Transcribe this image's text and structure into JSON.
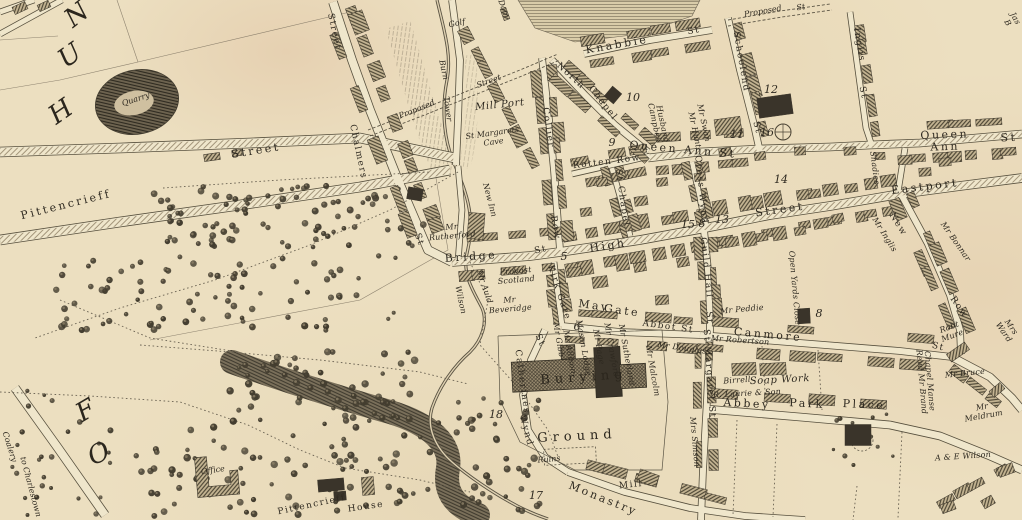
{
  "map": {
    "palette": {
      "paper": "#ecdfc0",
      "ink": "#3b352a",
      "road_fill": "#efe6cb",
      "building_hatch": "#6b6150",
      "dark_building": "#3a342a",
      "tree": "#433d2f"
    },
    "labels": [
      {
        "id": "letter-n",
        "text": "N",
        "x": 77,
        "y": 15,
        "r": -38,
        "c": "huge"
      },
      {
        "id": "letter-u",
        "text": "U",
        "x": 70,
        "y": 56,
        "r": -35,
        "c": "huge"
      },
      {
        "id": "letter-h",
        "text": "H",
        "x": 61,
        "y": 112,
        "r": -35,
        "c": "huge"
      },
      {
        "id": "letter-f",
        "text": "F",
        "x": 86,
        "y": 411,
        "r": -30,
        "c": "huge"
      },
      {
        "id": "letter-o",
        "text": "O",
        "x": 99,
        "y": 454,
        "r": -25,
        "c": "huge"
      },
      {
        "id": "quarry",
        "text": "Quarry",
        "x": 136,
        "y": 100,
        "r": -18,
        "c": "tiny-it"
      },
      {
        "id": "street-upper",
        "text": "Street",
        "x": 256,
        "y": 151,
        "r": -9,
        "c": "street"
      },
      {
        "id": "pittencrieff-street",
        "text": "Pittencrieff",
        "x": 66,
        "y": 205,
        "r": -14,
        "c": "street"
      },
      {
        "id": "chalmers",
        "text": "Chalmers",
        "x": 357,
        "y": 152,
        "r": 78,
        "c": "street-sm"
      },
      {
        "id": "chalmers-st",
        "text": "St",
        "x": 418,
        "y": 240,
        "r": 70,
        "c": "street-sm"
      },
      {
        "id": "street-top",
        "text": "Street",
        "x": 333,
        "y": 32,
        "r": 78,
        "c": "street-sm"
      },
      {
        "id": "golf",
        "text": "Golf",
        "x": 457,
        "y": 24,
        "r": -12,
        "c": "tiny-it"
      },
      {
        "id": "dam",
        "text": "Dam",
        "x": 503,
        "y": 9,
        "r": 70,
        "c": "tiny-it"
      },
      {
        "id": "tower-burn-1",
        "text": "Burn",
        "x": 443,
        "y": 70,
        "r": 78,
        "c": "tiny-it"
      },
      {
        "id": "tower-burn-2",
        "text": "Tower",
        "x": 447,
        "y": 109,
        "r": 82,
        "c": "tiny-it"
      },
      {
        "id": "proposed-street-w-1",
        "text": "Proposed",
        "x": 417,
        "y": 110,
        "r": -22,
        "c": "tiny-it"
      },
      {
        "id": "proposed-street-w-2",
        "text": "Street",
        "x": 489,
        "y": 82,
        "r": -20,
        "c": "tiny-it"
      },
      {
        "id": "mill-port",
        "text": "Mill Port",
        "x": 500,
        "y": 106,
        "r": -6,
        "c": "name-lg"
      },
      {
        "id": "st-margarets-cave",
        "text": "St Margarets\nCave",
        "x": 493,
        "y": 138,
        "r": -8,
        "c": "tiny-it"
      },
      {
        "id": "new-inn",
        "text": "New Inn",
        "x": 489,
        "y": 200,
        "r": 75,
        "c": "tiny-it"
      },
      {
        "id": "collier",
        "text": "Collier",
        "x": 547,
        "y": 128,
        "r": 82,
        "c": "street-sm"
      },
      {
        "id": "collier-row",
        "text": "Row",
        "x": 554,
        "y": 228,
        "r": 80,
        "c": "street-sm"
      },
      {
        "id": "north-chapel-1",
        "text": "North",
        "x": 570,
        "y": 77,
        "r": 42,
        "c": "street-sm"
      },
      {
        "id": "north-chapel-2",
        "text": "Chapel",
        "x": 602,
        "y": 104,
        "r": 52,
        "c": "street-sm"
      },
      {
        "id": "knabbie",
        "text": "Knabbie",
        "x": 617,
        "y": 45,
        "r": -10,
        "c": "street"
      },
      {
        "id": "knabbie-st",
        "text": "St",
        "x": 694,
        "y": 32,
        "r": -10,
        "c": "street-sm"
      },
      {
        "id": "proposed-street-ne-1",
        "text": "Proposed",
        "x": 763,
        "y": 12,
        "r": -10,
        "c": "tiny-it"
      },
      {
        "id": "proposed-street-ne-2",
        "text": "St",
        "x": 801,
        "y": 8,
        "r": -10,
        "c": "tiny-it"
      },
      {
        "id": "schoolend",
        "text": "Schoolend",
        "x": 740,
        "y": 62,
        "r": 80,
        "c": "street-sm"
      },
      {
        "id": "schoolend-st",
        "text": "St",
        "x": 756,
        "y": 128,
        "r": 75,
        "c": "street-sm"
      },
      {
        "id": "inglis",
        "text": "Inglis",
        "x": 858,
        "y": 45,
        "r": 80,
        "c": "street-sm"
      },
      {
        "id": "inglis-st",
        "text": "St",
        "x": 862,
        "y": 93,
        "r": 78,
        "c": "street-sm"
      },
      {
        "id": "queen-ann-st-w",
        "text": "Queen Ann St",
        "x": 683,
        "y": 150,
        "r": 5,
        "c": "street"
      },
      {
        "id": "queen-ann-e",
        "text": "Queen Ann",
        "x": 945,
        "y": 141,
        "r": -2,
        "c": "street"
      },
      {
        "id": "queen-ann-e-st",
        "text": "St",
        "x": 1009,
        "y": 138,
        "r": -2,
        "c": "street"
      },
      {
        "id": "rotten-row",
        "text": "Rotten Row",
        "x": 607,
        "y": 163,
        "r": -7,
        "c": "street-sm"
      },
      {
        "id": "chapel-st-vert",
        "text": "St Chapel",
        "x": 621,
        "y": 198,
        "r": 82,
        "c": "street-sm"
      },
      {
        "id": "cross-wynd",
        "text": "Cross Wynd",
        "x": 700,
        "y": 190,
        "r": 84,
        "c": "street-sm"
      },
      {
        "id": "eastport",
        "text": "Eastport",
        "x": 925,
        "y": 187,
        "r": -7,
        "c": "street"
      },
      {
        "id": "high",
        "text": "High",
        "x": 608,
        "y": 246,
        "r": -9,
        "c": "street"
      },
      {
        "id": "high-street-2",
        "text": "Street",
        "x": 780,
        "y": 210,
        "r": -8,
        "c": "street"
      },
      {
        "id": "bridge",
        "text": "Bridge",
        "x": 471,
        "y": 257,
        "r": -4,
        "c": "street"
      },
      {
        "id": "bridge-st",
        "text": "St",
        "x": 541,
        "y": 251,
        "r": -12,
        "c": "street-sm"
      },
      {
        "id": "guild-hall",
        "text": "Guild Hall",
        "x": 705,
        "y": 268,
        "r": 84,
        "c": "street-sm"
      },
      {
        "id": "guild-hall-st",
        "text": "St",
        "x": 708,
        "y": 318,
        "r": 84,
        "c": "street-sm"
      },
      {
        "id": "kirk-gate",
        "text": "Kirk Gate",
        "x": 558,
        "y": 293,
        "r": 72,
        "c": "street-sm"
      },
      {
        "id": "may",
        "text": "May",
        "x": 594,
        "y": 306,
        "r": 8,
        "c": "street"
      },
      {
        "id": "gate",
        "text": "Gate",
        "x": 622,
        "y": 311,
        "r": 8,
        "c": "street"
      },
      {
        "id": "abbot-st",
        "text": "Abbot St",
        "x": 668,
        "y": 328,
        "r": 8,
        "c": "street-sm"
      },
      {
        "id": "canmore",
        "text": "Canmore",
        "x": 768,
        "y": 335,
        "r": 5,
        "c": "street"
      },
      {
        "id": "canmore-st",
        "text": "St",
        "x": 938,
        "y": 348,
        "r": 15,
        "c": "street-sm"
      },
      {
        "id": "new-row-1",
        "text": "New",
        "x": 897,
        "y": 225,
        "r": 58,
        "c": "street-sm"
      },
      {
        "id": "new-row-2",
        "text": "Row",
        "x": 958,
        "y": 308,
        "r": 55,
        "c": "street-sm"
      },
      {
        "id": "st-margaret-st",
        "text": "St Margaret St",
        "x": 708,
        "y": 374,
        "r": 86,
        "c": "street-sm"
      },
      {
        "id": "st-catherines-1",
        "text": "St",
        "x": 539,
        "y": 341,
        "r": 65,
        "c": "street-s m"
      },
      {
        "id": "st-catherines-2",
        "text": "Catherines",
        "x": 521,
        "y": 382,
        "r": 82,
        "c": "street-sm"
      },
      {
        "id": "st-catherines-3",
        "text": "Wynd",
        "x": 525,
        "y": 431,
        "r": 75,
        "c": "street-sm"
      },
      {
        "id": "abbey",
        "text": "Abbey",
        "x": 747,
        "y": 404,
        "r": 3,
        "c": "street"
      },
      {
        "id": "park",
        "text": "Park",
        "x": 807,
        "y": 404,
        "r": 3,
        "c": "street"
      },
      {
        "id": "place",
        "text": "Place",
        "x": 864,
        "y": 405,
        "r": 3,
        "c": "street"
      },
      {
        "id": "monastry",
        "text": "Monastry",
        "x": 603,
        "y": 499,
        "r": 22,
        "c": "street"
      },
      {
        "id": "mill",
        "text": "Mill",
        "x": 631,
        "y": 486,
        "r": -6,
        "c": "street-sm"
      },
      {
        "id": "burying",
        "text": "Burying",
        "x": 584,
        "y": 378,
        "r": -4,
        "c": "place"
      },
      {
        "id": "ground",
        "text": "Ground",
        "x": 577,
        "y": 437,
        "r": -3,
        "c": "place"
      },
      {
        "id": "ruins",
        "text": "Ruins",
        "x": 549,
        "y": 460,
        "r": -5,
        "c": "tiny-it"
      },
      {
        "id": "coalery",
        "text": "Coalery",
        "x": 9,
        "y": 447,
        "r": 72,
        "c": "tiny-it"
      },
      {
        "id": "to-charlestown",
        "text": "to Charlestown",
        "x": 30,
        "y": 487,
        "r": 75,
        "c": "tiny-it"
      },
      {
        "id": "office",
        "text": "Office",
        "x": 213,
        "y": 471,
        "r": -8,
        "c": "tiny-it"
      },
      {
        "id": "pittencrieff-house-1",
        "text": "Pittencrieff",
        "x": 312,
        "y": 506,
        "r": -12,
        "c": "street-sm"
      },
      {
        "id": "pittencrieff-house-2",
        "text": "House",
        "x": 366,
        "y": 508,
        "r": -8,
        "c": "street-sm"
      },
      {
        "id": "mr-rutherford",
        "text": "Mr\nRutherford",
        "x": 452,
        "y": 232,
        "r": -5,
        "c": "name"
      },
      {
        "id": "provost-scotland",
        "text": "Provost\nScotland",
        "x": 516,
        "y": 276,
        "r": -5,
        "c": "name"
      },
      {
        "id": "mr-beveridge",
        "text": "Mr\nBeveridge",
        "x": 510,
        "y": 305,
        "r": -5,
        "c": "name"
      },
      {
        "id": "mr-auld",
        "text": "Mr Auld",
        "x": 484,
        "y": 287,
        "r": 72,
        "c": "name"
      },
      {
        "id": "wilson",
        "text": "Wilson",
        "x": 460,
        "y": 300,
        "r": 78,
        "c": "name"
      },
      {
        "id": "campbell",
        "text": "Campbell",
        "x": 654,
        "y": 123,
        "r": 78,
        "c": "name"
      },
      {
        "id": "husband",
        "text": "Husband",
        "x": 662,
        "y": 124,
        "r": 78,
        "c": "name"
      },
      {
        "id": "mr-hunt",
        "text": "Mr Hunt",
        "x": 694,
        "y": 130,
        "r": 78,
        "c": "name"
      },
      {
        "id": "mr-swan",
        "text": "Mr Swan",
        "x": 703,
        "y": 123,
        "r": 78,
        "c": "name"
      },
      {
        "id": "mr-inglis",
        "text": "Mr Inglis",
        "x": 884,
        "y": 235,
        "r": 58,
        "c": "name"
      },
      {
        "id": "mr-bonnar",
        "text": "Mr Bonnar",
        "x": 955,
        "y": 242,
        "r": 55,
        "c": "name"
      },
      {
        "id": "shadies",
        "text": "Shadies",
        "x": 874,
        "y": 168,
        "r": 83,
        "c": "name"
      },
      {
        "id": "open-yards-close",
        "text": "Open Yards Close",
        "x": 794,
        "y": 288,
        "r": 85,
        "c": "name"
      },
      {
        "id": "mr-gibb",
        "text": "Mr Gibb",
        "x": 558,
        "y": 340,
        "r": 80,
        "c": "name"
      },
      {
        "id": "mr-allison",
        "text": "Mr Allison",
        "x": 569,
        "y": 352,
        "r": 80,
        "c": "name"
      },
      {
        "id": "mason-lodge",
        "text": "Mason Lodge",
        "x": 583,
        "y": 348,
        "r": 80,
        "c": "name"
      },
      {
        "id": "mr-page",
        "text": "Mr Page",
        "x": 598,
        "y": 347,
        "r": 80,
        "c": "name"
      },
      {
        "id": "mr-crawford",
        "text": "Mr Crawford",
        "x": 611,
        "y": 350,
        "r": 80,
        "c": "name"
      },
      {
        "id": "mr-sutherland",
        "text": "Mr Sutherland",
        "x": 626,
        "y": 355,
        "r": 80,
        "c": "name"
      },
      {
        "id": "mr-malcolm",
        "text": "Mr Malcolm",
        "x": 652,
        "y": 371,
        "r": 80,
        "c": "name"
      },
      {
        "id": "mr-douglass",
        "text": "Mr Douglass",
        "x": 684,
        "y": 349,
        "r": 8,
        "c": "name"
      },
      {
        "id": "mr-peddie",
        "text": "Mr Peddie",
        "x": 742,
        "y": 310,
        "r": -5,
        "c": "name"
      },
      {
        "id": "mrs-simson",
        "text": "Mrs Simson",
        "x": 694,
        "y": 442,
        "r": 85,
        "c": "name"
      },
      {
        "id": "mr-robertson",
        "text": "Mr Robertson",
        "x": 740,
        "y": 341,
        "r": 4,
        "c": "name"
      },
      {
        "id": "birrell",
        "text": "Birrell",
        "x": 737,
        "y": 381,
        "r": -4,
        "c": "name"
      },
      {
        "id": "soap-work",
        "text": "Soap Work",
        "x": 780,
        "y": 381,
        "r": -3,
        "c": "name-lg"
      },
      {
        "id": "laurie-son",
        "text": "R. Laurie & Son",
        "x": 747,
        "y": 394,
        "r": -3,
        "c": "name"
      },
      {
        "id": "chapel-manse",
        "text": "Chapel Manse",
        "x": 929,
        "y": 381,
        "r": 85,
        "c": "name"
      },
      {
        "id": "revd-mr-brand",
        "text": "Revd Mr Brand",
        "x": 921,
        "y": 382,
        "r": 85,
        "c": "name"
      },
      {
        "id": "mr-bruce",
        "text": "Mr Bruce",
        "x": 965,
        "y": 374,
        "r": -6,
        "c": "name"
      },
      {
        "id": "robt-mure",
        "text": "Robt\nMure",
        "x": 951,
        "y": 332,
        "r": -20,
        "c": "name"
      },
      {
        "id": "mrs-ward",
        "text": "Mrs Ward",
        "x": 1007,
        "y": 330,
        "r": 55,
        "c": "name"
      },
      {
        "id": "mr-meldrum",
        "text": "Mr Meldrum",
        "x": 983,
        "y": 412,
        "r": -10,
        "c": "name"
      },
      {
        "id": "a-e-wilson",
        "text": "A & E Wilson",
        "x": 963,
        "y": 457,
        "r": -4,
        "c": "name"
      },
      {
        "id": "jas-b",
        "text": "Jas B",
        "x": 1011,
        "y": 21,
        "r": 60,
        "c": "name"
      },
      {
        "id": "num-5",
        "text": "5",
        "x": 564,
        "y": 257,
        "r": 0,
        "c": "num"
      },
      {
        "id": "num-6",
        "text": "6",
        "x": 577,
        "y": 327,
        "r": 0,
        "c": "num"
      },
      {
        "id": "num-8-high",
        "text": "8",
        "x": 702,
        "y": 224,
        "r": 0,
        "c": "num"
      },
      {
        "id": "num-8-yards",
        "text": "8",
        "x": 819,
        "y": 314,
        "r": 0,
        "c": "num"
      },
      {
        "id": "num-9",
        "text": "9",
        "x": 612,
        "y": 143,
        "r": 0,
        "c": "num"
      },
      {
        "id": "num-10",
        "text": "10",
        "x": 633,
        "y": 98,
        "r": 0,
        "c": "num"
      },
      {
        "id": "num-11",
        "text": "11",
        "x": 737,
        "y": 135,
        "r": 0,
        "c": "num"
      },
      {
        "id": "num-12",
        "text": "12",
        "x": 771,
        "y": 90,
        "r": 0,
        "c": "num"
      },
      {
        "id": "num-13",
        "text": "13",
        "x": 722,
        "y": 220,
        "r": 0,
        "c": "num"
      },
      {
        "id": "num-14",
        "text": "14",
        "x": 781,
        "y": 180,
        "r": 0,
        "c": "num"
      },
      {
        "id": "num-15",
        "text": "15",
        "x": 688,
        "y": 225,
        "r": 0,
        "c": "num"
      },
      {
        "id": "num-16",
        "text": "16",
        "x": 767,
        "y": 133,
        "r": 0,
        "c": "num"
      },
      {
        "id": "num-17",
        "text": "17",
        "x": 536,
        "y": 496,
        "r": 0,
        "c": "num"
      },
      {
        "id": "num-18",
        "text": "18",
        "x": 496,
        "y": 415,
        "r": 0,
        "c": "num"
      }
    ]
  }
}
